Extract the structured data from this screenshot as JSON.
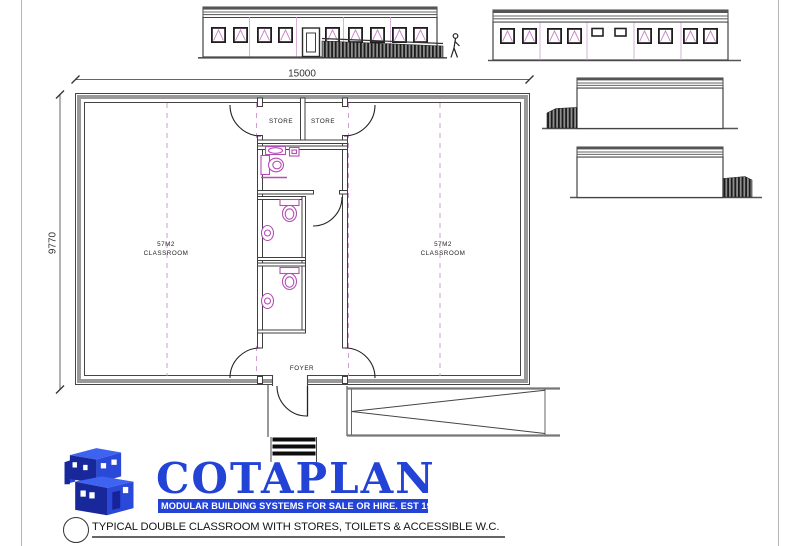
{
  "sheet": {
    "note": "TYPICAL DOUBLE CLASSROOM WITH STORES, TOILETS & ACCESSIBLE W.C."
  },
  "logo": {
    "name": "COTAPLAN",
    "tagline": "MODULAR BUILDING SYSTEMS FOR SALE OR HIRE. EST 1982",
    "brand_blue": "#2343d6"
  },
  "plan": {
    "dimensions": {
      "width": "15000",
      "height": "9770"
    },
    "rooms": {
      "store_left": "STORE",
      "store_right": "STORE",
      "foyer": "FOYER",
      "classroom_left": {
        "area": "57M2",
        "label": "CLASSROOM"
      },
      "classroom_right": {
        "area": "57M2",
        "label": "CLASSROOM"
      }
    }
  },
  "colors": {
    "fixture_magenta": "#b44fb4",
    "module_joint_pink": "#cf8fcf",
    "line_dark": "#3a3a3a",
    "wall_grey": "#999999"
  }
}
